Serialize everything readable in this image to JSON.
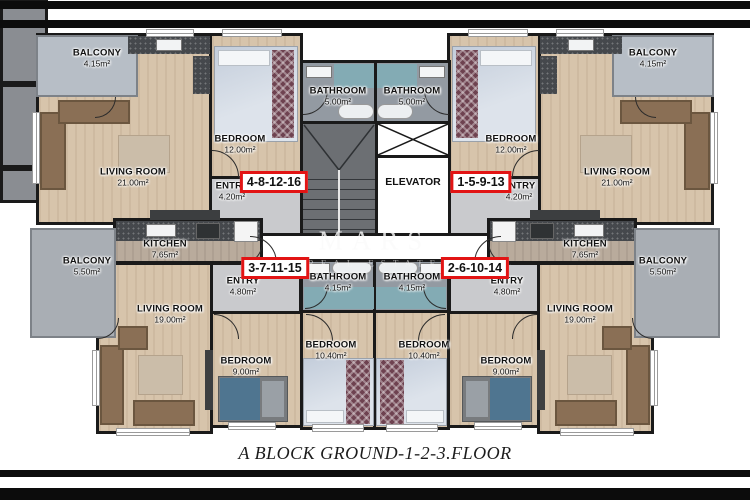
{
  "caption": "A BLOCK GROUND-1-2-3.FLOOR",
  "watermark": {
    "brand": "MARS",
    "subtitle": "REAL ESTATE"
  },
  "core": {
    "elevator": "ELEVATOR"
  },
  "units": [
    {
      "id": "4-8-12-16",
      "position": "top-left"
    },
    {
      "id": "1-5-9-13",
      "position": "top-right"
    },
    {
      "id": "3-7-11-15",
      "position": "middle-left"
    },
    {
      "id": "2-6-10-14",
      "position": "middle-right"
    }
  ],
  "rooms": [
    {
      "name": "BALCONY",
      "area": "4.15m²"
    },
    {
      "name": "LIVING ROOM",
      "area": "21.00m²"
    },
    {
      "name": "BEDROOM",
      "area": "12.00m²"
    },
    {
      "name": "ENTRY",
      "area": "4.20m²"
    },
    {
      "name": "BATHROOM",
      "area": "5.00m²"
    },
    {
      "name": "BATHROOM",
      "area": "5.00m²"
    },
    {
      "name": "BEDROOM",
      "area": "12.00m²"
    },
    {
      "name": "LIVING ROOM",
      "area": "21.00m²"
    },
    {
      "name": "BALCONY",
      "area": "4.15m²"
    },
    {
      "name": "ENTRY",
      "area": "4.20m²"
    },
    {
      "name": "KITCHEN",
      "area": "7.65m²"
    },
    {
      "name": "BALCONY",
      "area": "5.50m²"
    },
    {
      "name": "ENTRY",
      "area": "4.80m²"
    },
    {
      "name": "KITCHEN",
      "area": "7.65m²"
    },
    {
      "name": "BALCONY",
      "area": "5.50m²"
    },
    {
      "name": "ENTRY",
      "area": "4.80m²"
    },
    {
      "name": "BATHROOM",
      "area": "4.15m²"
    },
    {
      "name": "BATHROOM",
      "area": "4.15m²"
    },
    {
      "name": "LIVING ROOM",
      "area": "19.00m²"
    },
    {
      "name": "BEDROOM",
      "area": "9.00m²"
    },
    {
      "name": "BEDROOM",
      "area": "10.40m²"
    },
    {
      "name": "BEDROOM",
      "area": "10.40m²"
    },
    {
      "name": "BEDROOM",
      "area": "9.00m²"
    },
    {
      "name": "LIVING ROOM",
      "area": "19.00m²"
    }
  ],
  "colors": {
    "wall": "#1a1a1a",
    "badge_border": "#e21414",
    "wood": "#d7c4ab",
    "shower": "#83abb4"
  }
}
